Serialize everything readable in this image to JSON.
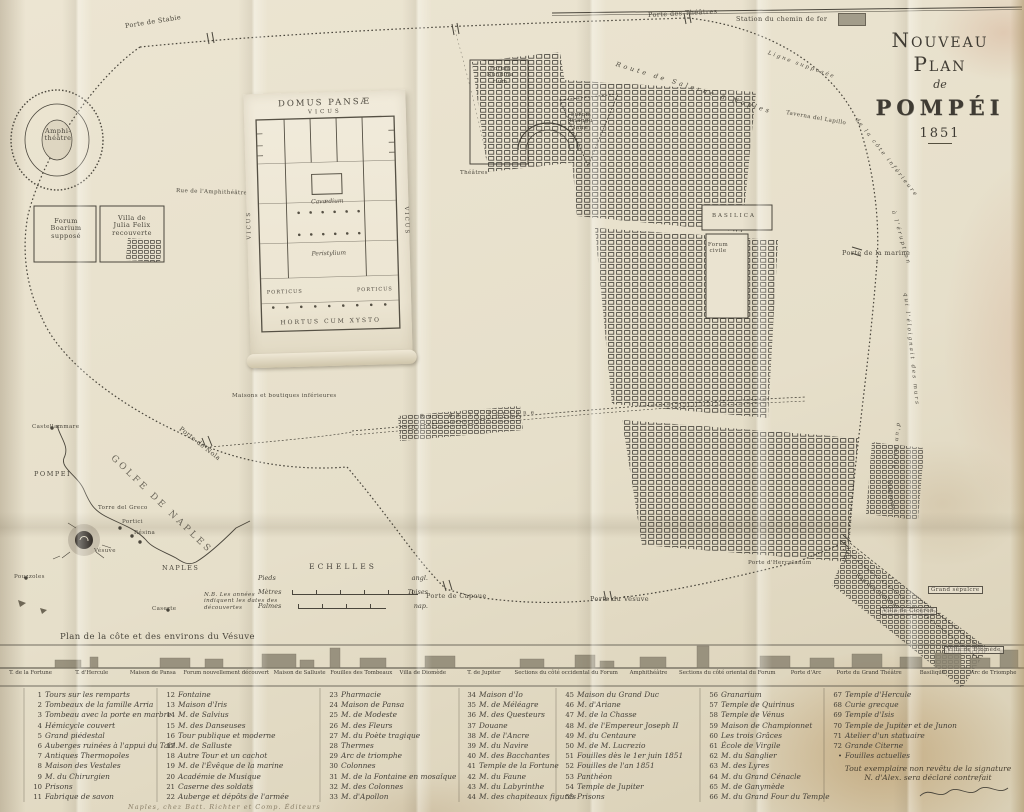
{
  "title": {
    "l1": "Nouveau Plan",
    "l2": "de",
    "l3": "POMPÉI",
    "year": "1851"
  },
  "railway": {
    "station": "Station du chemin de fer"
  },
  "map_labels": {
    "porte_stabie": "Porte de Stabie",
    "porte_theatres": "Porte des Théâtres",
    "route_salerne": "Route de Salerne à Naples",
    "ligne1": "Ligne supposée",
    "ligne2": "de la côte inférieure",
    "ligne3": "à l'éruption",
    "ligne4": "qui l'éloignait des murs",
    "ligne5": "d'un mille",
    "taverna": "Taverna del Lapillo",
    "amphitheatre1": "Amphi-",
    "amphitheatre2": "théâtre",
    "forum_boarium1": "Forum",
    "forum_boarium2": "Boarium",
    "forum_boarium3": "supposé",
    "villa_julia1": "Villa de",
    "villa_julia2": "Julia Felix",
    "villa_julia3": "recouverte",
    "rue_amphi": "Rue de l'Amphithéâtre",
    "forum_nundinarium1": "Forum",
    "forum_nundinarium2": "Nundina",
    "forum_nundinarium3": "rium",
    "forum_triangulaire1": "Forum",
    "forum_triangulaire2": "triangu",
    "forum_triangulaire3": "laire",
    "theatres": "Théâtres",
    "basilica": "BASILICA",
    "forum_civile1": "Forum",
    "forum_civile2": "civile",
    "porte_marine": "Porte de la marine",
    "rue_fortune": "Rue de la Fortune",
    "maisons_boutiques": "Maisons et boutiques inférieures",
    "porte_nola": "Porte de Nola",
    "porte_capoue": "Porte de Capoue",
    "porte_vesuve": "Porte du Vésuve",
    "porte_herculanum": "Porte d'Herculanum",
    "rue_tombeaux": "Rue des tombeaux",
    "villa_ciceron": "Villa de Cicéron",
    "grand_sepulcre": "Grand sépulcre",
    "villa_diomede": "Villa de Diomède",
    "magasins": "Magasins"
  },
  "domus": {
    "title": "DOMUS PANSÆ",
    "vicus_top": "VICUS",
    "vicus_left": "VICUS",
    "vicus_right": "VICUS",
    "cavaedium": "Cavædium",
    "peristylium": "Peristylium",
    "porticus_l": "PORTICUS",
    "porticus_r": "PORTICUS",
    "hortus": "HORTUS CUM XYSTO"
  },
  "gulf": {
    "sea": "GOLFE DE NAPLES",
    "castellammare": "Castellammare",
    "pompei": "POMPEI",
    "vesuve": "Vésuve",
    "naples": "NAPLES",
    "portici": "Portici",
    "resina": "Résina",
    "torre_greco": "Torre del Greco",
    "pouzzoles": "Pouzzoles",
    "caserte": "Caserte",
    "note1": "N.B. Les années",
    "note2": "indiquent les dates des",
    "note3": "découvertes",
    "caption": "Plan de la côte et des environs du Vésuve"
  },
  "echelles": {
    "title": "ECHELLES",
    "rows": [
      {
        "name": "Pieds",
        "end": "angl."
      },
      {
        "name": "Mètres",
        "end": "Toises"
      },
      {
        "name": "Palmes",
        "end": "nap."
      }
    ]
  },
  "strip": {
    "sections": [
      "T. de la Fortune",
      "T. d'Hercule",
      "Maison de Pansa",
      "Forum nouvellement découvert",
      "Maison de Salluste",
      "Fouilles des Tombeaux",
      "Villa de Diomède",
      "T. de Jupiter",
      "Sections du côté occidental du Forum",
      "Amphithéâtre",
      "Sections du côté oriental du Forum",
      "Porte d'Arc",
      "Porte du Grand Théâtre",
      "Basilique",
      "Arc de Triomphe"
    ]
  },
  "legend": {
    "columns": [
      [
        {
          "n": "1",
          "label": "Tours sur les remparts"
        },
        {
          "n": "2",
          "label": "Tombeaux de la famille Arria"
        },
        {
          "n": "3",
          "label": "Tombeau avec la porte en marbre"
        },
        {
          "n": "4",
          "label": "Hémicycle couvert"
        },
        {
          "n": "5",
          "label": "Grand piédestal"
        },
        {
          "n": "6",
          "label": "Auberges ruinées à l'appui du Tabl."
        },
        {
          "n": "7",
          "label": "Antiques Thermopoles"
        },
        {
          "n": "8",
          "label": "Maison des Vestales"
        },
        {
          "n": "9",
          "label": "M. du Chirurgien"
        },
        {
          "n": "10",
          "label": "Prisons"
        },
        {
          "n": "11",
          "label": "Fabrique de savon"
        }
      ],
      [
        {
          "n": "12",
          "label": "Fontaine"
        },
        {
          "n": "13",
          "label": "Maison d'Iris"
        },
        {
          "n": "14",
          "label": "M. de Salvius"
        },
        {
          "n": "15",
          "label": "M. des Danseuses"
        },
        {
          "n": "16",
          "label": "Tour publique et moderne"
        },
        {
          "n": "17",
          "label": "M. de Salluste"
        },
        {
          "n": "18",
          "label": "Autre Tour et un cachot"
        },
        {
          "n": "19",
          "label": "M. de l'Évêque de la marine"
        },
        {
          "n": "20",
          "label": "Académie de Musique"
        },
        {
          "n": "21",
          "label": "Caserne des soldats"
        },
        {
          "n": "22",
          "label": "Auberge et dépôts de l'armée"
        }
      ],
      [
        {
          "n": "23",
          "label": "Pharmacie"
        },
        {
          "n": "24",
          "label": "Maison de Pansa"
        },
        {
          "n": "25",
          "label": "M. de Modeste"
        },
        {
          "n": "26",
          "label": "M. des Fleurs"
        },
        {
          "n": "27",
          "label": "M. du Poète tragique"
        },
        {
          "n": "28",
          "label": "Thermes"
        },
        {
          "n": "29",
          "label": "Arc de triomphe"
        },
        {
          "n": "30",
          "label": "Colonnes"
        },
        {
          "n": "31",
          "label": "M. de la Fontaine en mosaïque"
        },
        {
          "n": "32",
          "label": "M. des Colonnes"
        },
        {
          "n": "33",
          "label": "M. d'Apollon"
        }
      ],
      [
        {
          "n": "34",
          "label": "Maison d'Io"
        },
        {
          "n": "35",
          "label": "M. de Méléagre"
        },
        {
          "n": "36",
          "label": "M. des Questeurs"
        },
        {
          "n": "37",
          "label": "Douane"
        },
        {
          "n": "38",
          "label": "M. de l'Ancre"
        },
        {
          "n": "39",
          "label": "M. du Navire"
        },
        {
          "n": "40",
          "label": "M. des Bacchantes"
        },
        {
          "n": "41",
          "label": "Temple de la Fortune"
        },
        {
          "n": "42",
          "label": "M. du Faune"
        },
        {
          "n": "43",
          "label": "M. du Labyrinthe"
        },
        {
          "n": "44",
          "label": "M. des chapiteaux figurés"
        }
      ],
      [
        {
          "n": "45",
          "label": "Maison du Grand Duc"
        },
        {
          "n": "46",
          "label": "M. d'Ariane"
        },
        {
          "n": "47",
          "label": "M. de la Chasse"
        },
        {
          "n": "48",
          "label": "M. de l'Empereur Joseph II"
        },
        {
          "n": "49",
          "label": "M. du Centaure"
        },
        {
          "n": "50",
          "label": "M. de M. Lucrezio"
        },
        {
          "n": "51",
          "label": "Fouilles dès le 1er juin 1851"
        },
        {
          "n": "52",
          "label": "Fouilles de l'an 1851"
        },
        {
          "n": "53",
          "label": "Panthéon"
        },
        {
          "n": "54",
          "label": "Temple de Jupiter"
        },
        {
          "n": "55",
          "label": "Prisons"
        }
      ],
      [
        {
          "n": "56",
          "label": "Granarium"
        },
        {
          "n": "57",
          "label": "Temple de Quirinus"
        },
        {
          "n": "58",
          "label": "Temple de Vénus"
        },
        {
          "n": "59",
          "label": "Maison de Championnet"
        },
        {
          "n": "60",
          "label": "Les trois Grâces"
        },
        {
          "n": "61",
          "label": "École de Virgile"
        },
        {
          "n": "62",
          "label": "M. du Sanglier"
        },
        {
          "n": "63",
          "label": "M. des Lyres"
        },
        {
          "n": "64",
          "label": "M. du Grand Cénacle"
        },
        {
          "n": "65",
          "label": "M. de Ganymède"
        },
        {
          "n": "66",
          "label": "M. du Grand Four du Temple"
        }
      ],
      [
        {
          "n": "67",
          "label": "Temple d'Hercule"
        },
        {
          "n": "68",
          "label": "Curie grecque"
        },
        {
          "n": "69",
          "label": "Temple d'Isis"
        },
        {
          "n": "70",
          "label": "Temple de Jupiter et de Junon"
        },
        {
          "n": "71",
          "label": "Atelier d'un statuaire"
        },
        {
          "n": "72",
          "label": "Grande Citerne"
        },
        {
          "n": "•",
          "label": "Fouilles actuelles"
        }
      ]
    ]
  },
  "notes": {
    "line1": "Tout exemplaire non revêtu de la signature",
    "line2": "N. d'Alex. sera déclaré contrefait",
    "imprint": "Naples, chez Batt. Richter et Comp. Éditeurs"
  },
  "colors": {
    "paper": "#e7e0cd",
    "ink": "#45413a",
    "stain": "#a9834e"
  }
}
